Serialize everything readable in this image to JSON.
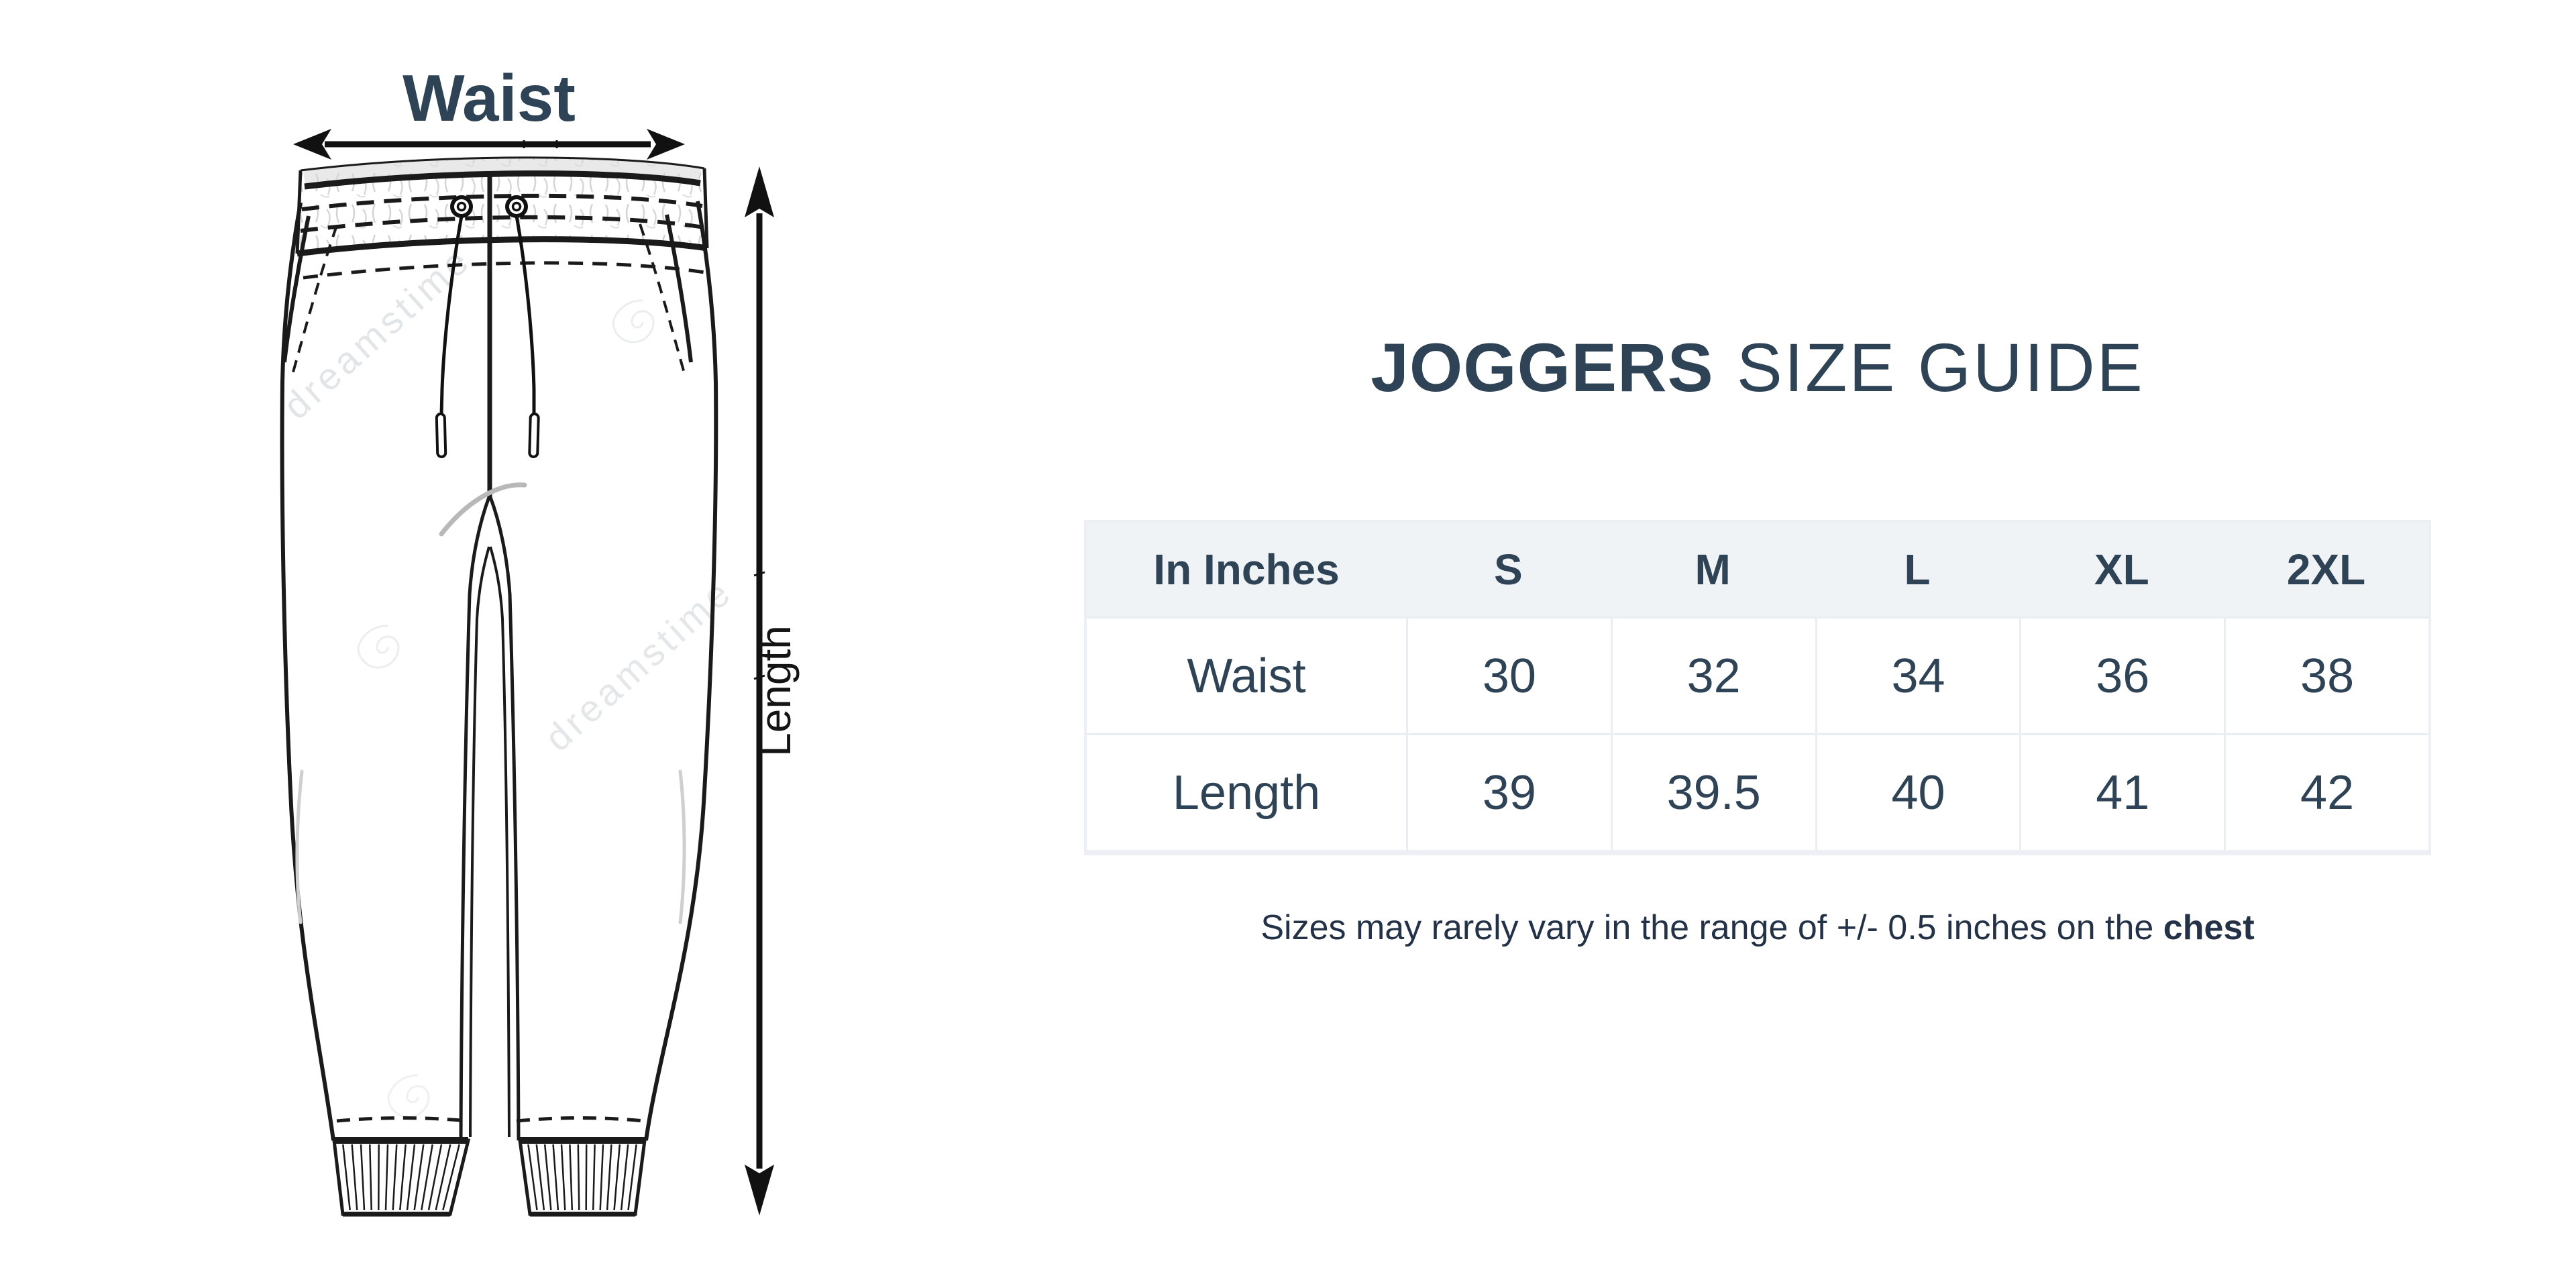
{
  "page": {
    "background": "#ffffff"
  },
  "diagram": {
    "waist_label": "Waist",
    "length_label": "Length",
    "watermark_text": "dreamstime"
  },
  "guide": {
    "title_product": "JOGGERS",
    "title_suffix": "SIZE GUIDE",
    "table": {
      "columns": [
        "In Inches",
        "S",
        "M",
        "L",
        "XL",
        "2XL"
      ],
      "rows": [
        {
          "label": "Waist",
          "values": [
            "30",
            "32",
            "34",
            "36",
            "38"
          ]
        },
        {
          "label": "Length",
          "values": [
            "39",
            "39.5",
            "40",
            "41",
            "42"
          ]
        }
      ]
    },
    "note_prefix": "Sizes may rarely vary in the range of +/- 0.5 inches on the ",
    "note_bold": "chest",
    "colors": {
      "navy": "#2f4356",
      "header_bg": "#f0f3f6",
      "table_border": "#e9eef2"
    }
  }
}
